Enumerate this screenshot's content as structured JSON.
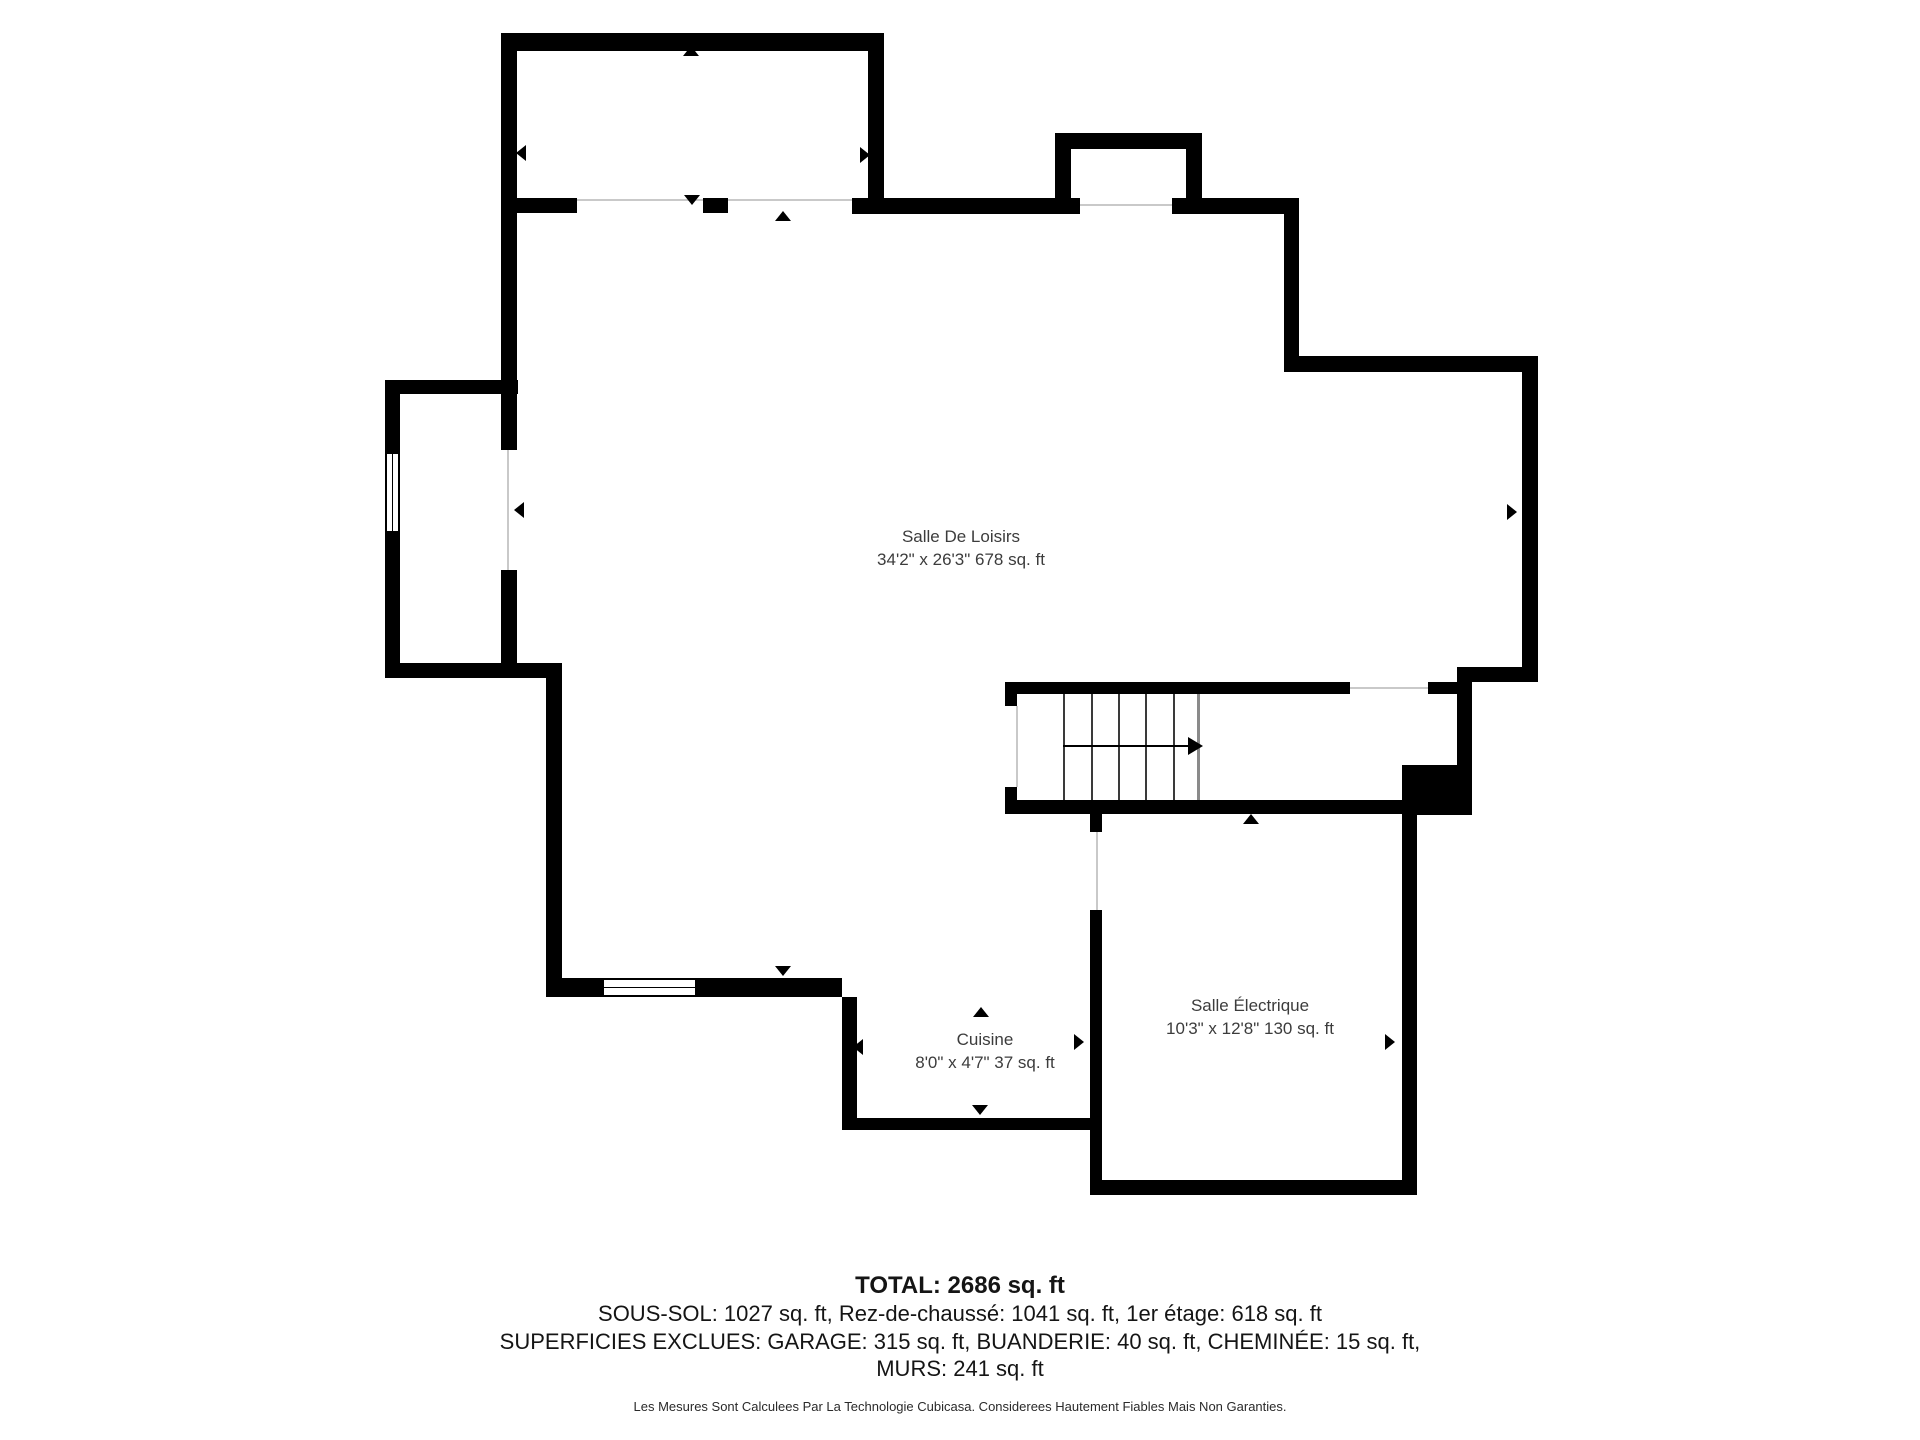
{
  "meta": {
    "document_type": "floor-plan",
    "floor_shown": "Sous-sol (basement)",
    "wall_color": "#000000",
    "background_color": "#ffffff",
    "hairline_color": "#c9c9c9",
    "label_color": "#3c3c3c"
  },
  "plan": {
    "canvas": {
      "w": 1920,
      "h": 1440
    },
    "walls": [
      {
        "x": 501,
        "y": 33,
        "w": 383,
        "h": 18
      },
      {
        "x": 501,
        "y": 33,
        "w": 16,
        "h": 417
      },
      {
        "x": 501,
        "y": 570,
        "w": 16,
        "h": 108
      },
      {
        "x": 868,
        "y": 33,
        "w": 16,
        "h": 180
      },
      {
        "x": 517,
        "y": 198,
        "w": 60,
        "h": 15
      },
      {
        "x": 703,
        "y": 198,
        "w": 25,
        "h": 15
      },
      {
        "x": 852,
        "y": 198,
        "w": 228,
        "h": 16
      },
      {
        "x": 1172,
        "y": 198,
        "w": 127,
        "h": 16
      },
      {
        "x": 1055,
        "y": 133,
        "w": 147,
        "h": 16
      },
      {
        "x": 1055,
        "y": 133,
        "w": 16,
        "h": 81
      },
      {
        "x": 1186,
        "y": 133,
        "w": 16,
        "h": 81
      },
      {
        "x": 1284,
        "y": 198,
        "w": 15,
        "h": 174
      },
      {
        "x": 1284,
        "y": 356,
        "w": 254,
        "h": 16
      },
      {
        "x": 1522,
        "y": 356,
        "w": 16,
        "h": 326
      },
      {
        "x": 1457,
        "y": 667,
        "w": 81,
        "h": 15
      },
      {
        "x": 1457,
        "y": 667,
        "w": 15,
        "h": 103
      },
      {
        "x": 1402,
        "y": 765,
        "w": 70,
        "h": 50
      },
      {
        "x": 1005,
        "y": 682,
        "w": 345,
        "h": 12
      },
      {
        "x": 1428,
        "y": 682,
        "w": 29,
        "h": 12
      },
      {
        "x": 1005,
        "y": 682,
        "w": 12,
        "h": 24
      },
      {
        "x": 1005,
        "y": 787,
        "w": 12,
        "h": 27
      },
      {
        "x": 1005,
        "y": 800,
        "w": 399,
        "h": 14
      },
      {
        "x": 1090,
        "y": 814,
        "w": 12,
        "h": 18
      },
      {
        "x": 1090,
        "y": 910,
        "w": 12,
        "h": 285
      },
      {
        "x": 1402,
        "y": 814,
        "w": 15,
        "h": 381
      },
      {
        "x": 1090,
        "y": 1180,
        "w": 327,
        "h": 15
      },
      {
        "x": 385,
        "y": 380,
        "w": 133,
        "h": 14
      },
      {
        "x": 385,
        "y": 380,
        "w": 15,
        "h": 72
      },
      {
        "x": 385,
        "y": 533,
        "w": 15,
        "h": 145
      },
      {
        "x": 385,
        "y": 663,
        "w": 177,
        "h": 15
      },
      {
        "x": 546,
        "y": 678,
        "w": 16,
        "h": 300
      },
      {
        "x": 546,
        "y": 978,
        "w": 56,
        "h": 19
      },
      {
        "x": 697,
        "y": 978,
        "w": 145,
        "h": 19
      },
      {
        "x": 842,
        "y": 997,
        "w": 15,
        "h": 133
      },
      {
        "x": 842,
        "y": 1118,
        "w": 248,
        "h": 12
      }
    ],
    "hairlines": [
      {
        "x": 577,
        "y": 199,
        "w": 126,
        "h": 2
      },
      {
        "x": 728,
        "y": 199,
        "w": 124,
        "h": 2
      },
      {
        "x": 1080,
        "y": 204,
        "w": 92,
        "h": 2
      },
      {
        "x": 1350,
        "y": 687,
        "w": 78,
        "h": 2
      },
      {
        "x": 1016,
        "y": 706,
        "w": 2,
        "h": 81
      },
      {
        "x": 1096,
        "y": 832,
        "w": 2,
        "h": 78
      },
      {
        "x": 507,
        "y": 450,
        "w": 2,
        "h": 120
      }
    ],
    "windows": [
      {
        "x": 385,
        "y": 452,
        "w": 15,
        "h": 81,
        "orient": "v"
      },
      {
        "x": 602,
        "y": 978,
        "w": 95,
        "h": 19,
        "orient": "h"
      }
    ],
    "door_markers": [
      {
        "dir": "up",
        "x": 691,
        "y": 51
      },
      {
        "dir": "left",
        "x": 521,
        "y": 153
      },
      {
        "dir": "right",
        "x": 865,
        "y": 155
      },
      {
        "dir": "down",
        "x": 692,
        "y": 200
      },
      {
        "dir": "up",
        "x": 783,
        "y": 216
      },
      {
        "dir": "left",
        "x": 519,
        "y": 510
      },
      {
        "dir": "right",
        "x": 1512,
        "y": 512
      },
      {
        "dir": "down",
        "x": 783,
        "y": 971
      },
      {
        "dir": "left",
        "x": 858,
        "y": 1047
      },
      {
        "dir": "up",
        "x": 981,
        "y": 1012
      },
      {
        "dir": "down",
        "x": 980,
        "y": 1110
      },
      {
        "dir": "up",
        "x": 1251,
        "y": 819
      },
      {
        "dir": "right",
        "x": 1079,
        "y": 1042
      },
      {
        "dir": "right",
        "x": 1390,
        "y": 1042
      }
    ],
    "stairs": {
      "treads_x": [
        1063,
        1091,
        1118,
        1145,
        1173
      ],
      "tread_top": 694,
      "tread_bottom": 800,
      "landing_x": 1197,
      "arrow": {
        "x1": 1063,
        "x2": 1188,
        "y": 746
      }
    },
    "rooms": [
      {
        "id": "salle-de-loisirs",
        "name": "Salle De Loisirs",
        "dims": "34'2\" x 26'3\" 678 sq. ft",
        "cx": 961,
        "cy": 548
      },
      {
        "id": "cuisine",
        "name": "Cuisine",
        "dims": "8'0\" x 4'7\" 37 sq. ft",
        "cx": 985,
        "cy": 1051
      },
      {
        "id": "salle-electrique",
        "name": "Salle Électrique",
        "dims": "10'3\" x 12'8\" 130 sq. ft",
        "cx": 1250,
        "cy": 1017
      }
    ]
  },
  "summary": {
    "total": "TOTAL: 2686 sq. ft",
    "line1": "SOUS-SOL: 1027 sq. ft, Rez-de-chaussé: 1041 sq. ft, 1er étage: 618 sq. ft",
    "line2": "SUPERFICIES EXCLUES: GARAGE: 315 sq. ft, BUANDERIE: 40 sq. ft, CHEMINÉE: 15 sq. ft,",
    "line3": "MURS: 241 sq. ft",
    "disclaimer": "Les Mesures Sont Calculees Par La Technologie Cubicasa. Considerees Hautement Fiables Mais Non Garanties."
  }
}
